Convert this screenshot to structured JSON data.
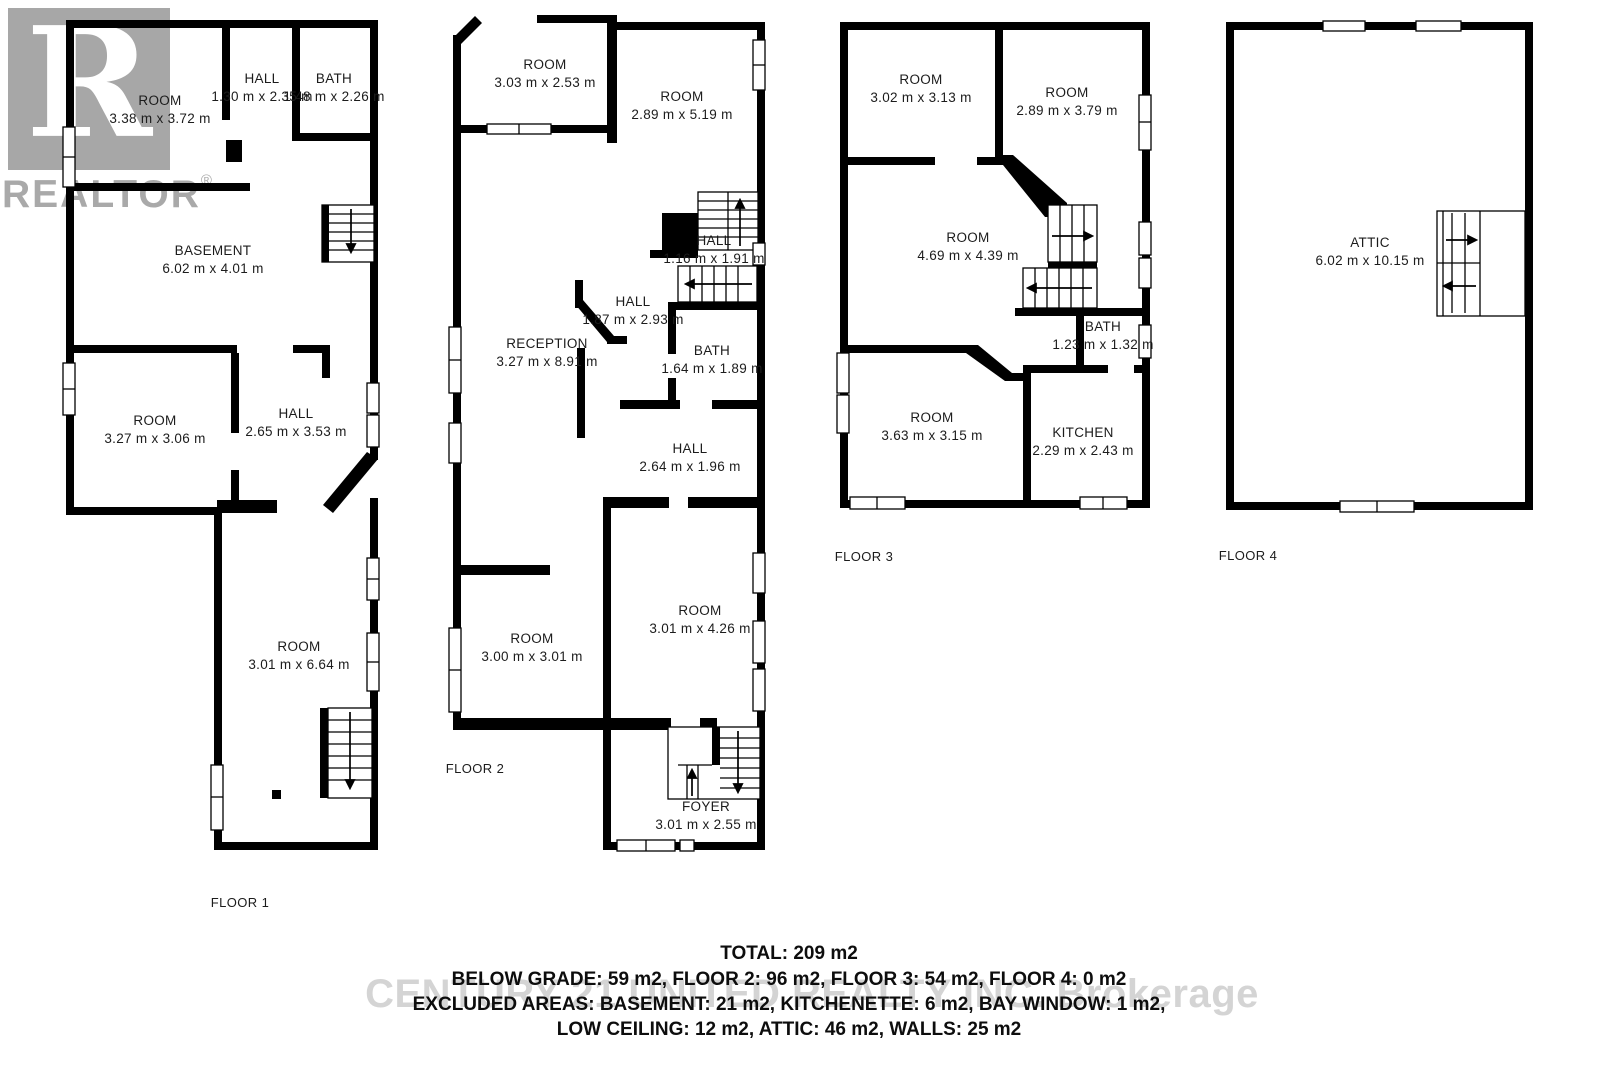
{
  "branding": {
    "logo_letter": "R",
    "logo_text": "REALTOR",
    "registered_mark": "®",
    "logo_color": "#a7a7a7",
    "watermark_text": "CENTURY 21 UNITED REALTY INC. Brokerage",
    "watermark_color": "#b9b9b9"
  },
  "colors": {
    "wall": "#000000",
    "label_text": "#1c1c1c",
    "background": "#ffffff"
  },
  "floors": [
    {
      "caption": "FLOOR 1",
      "rooms": [
        {
          "name": "ROOM",
          "dims": "3.38 m x 3.72 m"
        },
        {
          "name": "HALL",
          "dims": "1.30 m x 2.35 m"
        },
        {
          "name": "BATH",
          "dims": "1.48 m x 2.26 m"
        },
        {
          "name": "BASEMENT",
          "dims": "6.02 m x 4.01 m"
        },
        {
          "name": "ROOM",
          "dims": "3.27 m x 3.06 m"
        },
        {
          "name": "HALL",
          "dims": "2.65 m x 3.53 m"
        },
        {
          "name": "ROOM",
          "dims": "3.01 m x 6.64 m"
        }
      ]
    },
    {
      "caption": "FLOOR 2",
      "rooms": [
        {
          "name": "ROOM",
          "dims": "3.03 m x 2.53 m"
        },
        {
          "name": "ROOM",
          "dims": "2.89 m x 5.19 m"
        },
        {
          "name": "HALL",
          "dims": "1.16 m x 1.91 m"
        },
        {
          "name": "HALL",
          "dims": "1.87 m x 2.93 m"
        },
        {
          "name": "RECEPTION",
          "dims": "3.27 m x 8.91 m"
        },
        {
          "name": "BATH",
          "dims": "1.64 m x 1.89 m"
        },
        {
          "name": "HALL",
          "dims": "2.64 m x 1.96 m"
        },
        {
          "name": "ROOM",
          "dims": "3.00 m x 3.01 m"
        },
        {
          "name": "ROOM",
          "dims": "3.01 m x 4.26 m"
        },
        {
          "name": "FOYER",
          "dims": "3.01 m x 2.55 m"
        }
      ]
    },
    {
      "caption": "FLOOR 3",
      "rooms": [
        {
          "name": "ROOM",
          "dims": "3.02 m x 3.13 m"
        },
        {
          "name": "ROOM",
          "dims": "2.89 m x 3.79 m"
        },
        {
          "name": "ROOM",
          "dims": "4.69 m x 4.39 m"
        },
        {
          "name": "BATH",
          "dims": "1.23 m x 1.32 m"
        },
        {
          "name": "ROOM",
          "dims": "3.63 m x 3.15 m"
        },
        {
          "name": "KITCHEN",
          "dims": "2.29 m x 2.43 m"
        }
      ]
    },
    {
      "caption": "FLOOR 4",
      "rooms": [
        {
          "name": "ATTIC",
          "dims": "6.02 m x 10.15 m"
        }
      ]
    }
  ],
  "summary": {
    "total": "TOTAL: 209 m2",
    "line1": "BELOW GRADE: 59 m2, FLOOR 2: 96 m2, FLOOR 3: 54 m2, FLOOR 4: 0 m2",
    "line2": "EXCLUDED AREAS: BASEMENT: 21 m2, KITCHENETTE: 6 m2, BAY WINDOW: 1 m2,",
    "line3": "LOW CEILING: 12 m2, ATTIC: 46 m2, WALLS: 25 m2"
  }
}
